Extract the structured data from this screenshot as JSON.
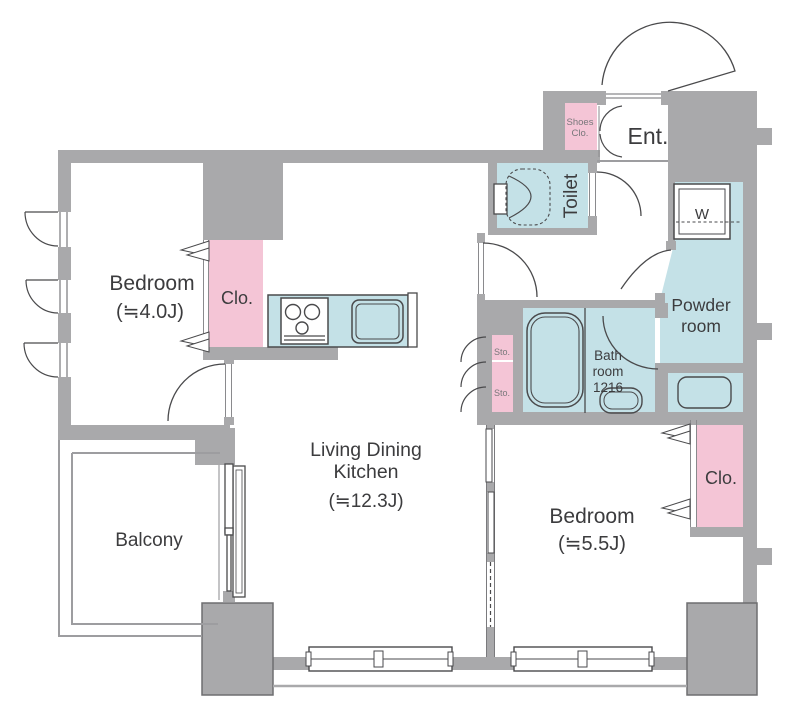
{
  "plan": {
    "type": "apartment-floor-plan",
    "colors": {
      "wall_gray": "#a9a9ab",
      "room_blue": "#c4e1e7",
      "closet_pink": "#f4c5d6",
      "fixture_outline": "#4a4a4c",
      "text_dark": "#3c3c3e",
      "text_muted": "#77777a",
      "background": "#ffffff"
    },
    "rooms": {
      "bedroom1": {
        "label": "Bedroom",
        "size": "(≒4.0J)"
      },
      "bedroom2": {
        "label": "Bedroom",
        "size": "(≒5.5J)"
      },
      "ldk": {
        "label_line1": "Living Dining",
        "label_line2": "Kitchen",
        "size": "(≒12.3J)"
      },
      "balcony": {
        "label": "Balcony"
      },
      "toilet": {
        "label": "Toilet"
      },
      "powder_room": {
        "label_line1": "Powder",
        "label_line2": "room"
      },
      "bathroom": {
        "label_line1": "Bath",
        "label_line2": "room",
        "label_line3": "1216"
      },
      "entrance": {
        "label": "Ent."
      },
      "shoes_closet": {
        "label_line1": "Shoes",
        "label_line2": "Clo."
      },
      "closet1": {
        "label": "Clo."
      },
      "closet2": {
        "label": "Clo."
      },
      "storage1": {
        "label": "Sto."
      },
      "storage2": {
        "label": "Sto."
      },
      "washer": {
        "label": "W"
      }
    }
  }
}
